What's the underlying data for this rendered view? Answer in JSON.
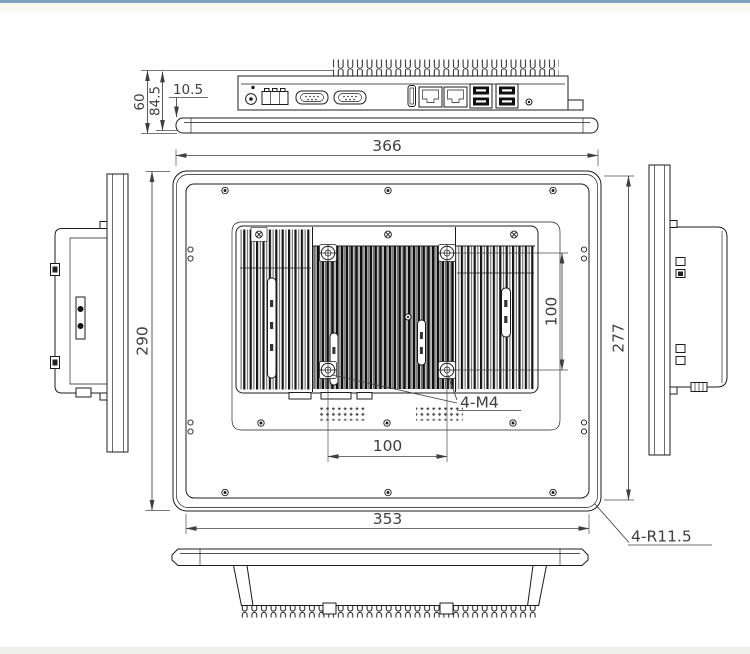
{
  "page": {
    "background": "#ffffff",
    "top_bar_color": "#7fa1c4",
    "top_strip_color": "#faf9ef",
    "bottom_strip_color": "#efefee"
  },
  "drawing": {
    "ink_color": "#1c1c1c",
    "dim_color": "#3f3f3f",
    "dims": {
      "top_width": "366",
      "left_height": "290",
      "right_height": "277",
      "vesa_vertical": "100",
      "vesa_horizontal": "100",
      "bottom_width": "353",
      "depth_total": "60",
      "depth_rear": "84.5",
      "panel_thickness": "10.5",
      "mount_holes": "4-M4",
      "corner_radius": "4-R11.5"
    }
  }
}
